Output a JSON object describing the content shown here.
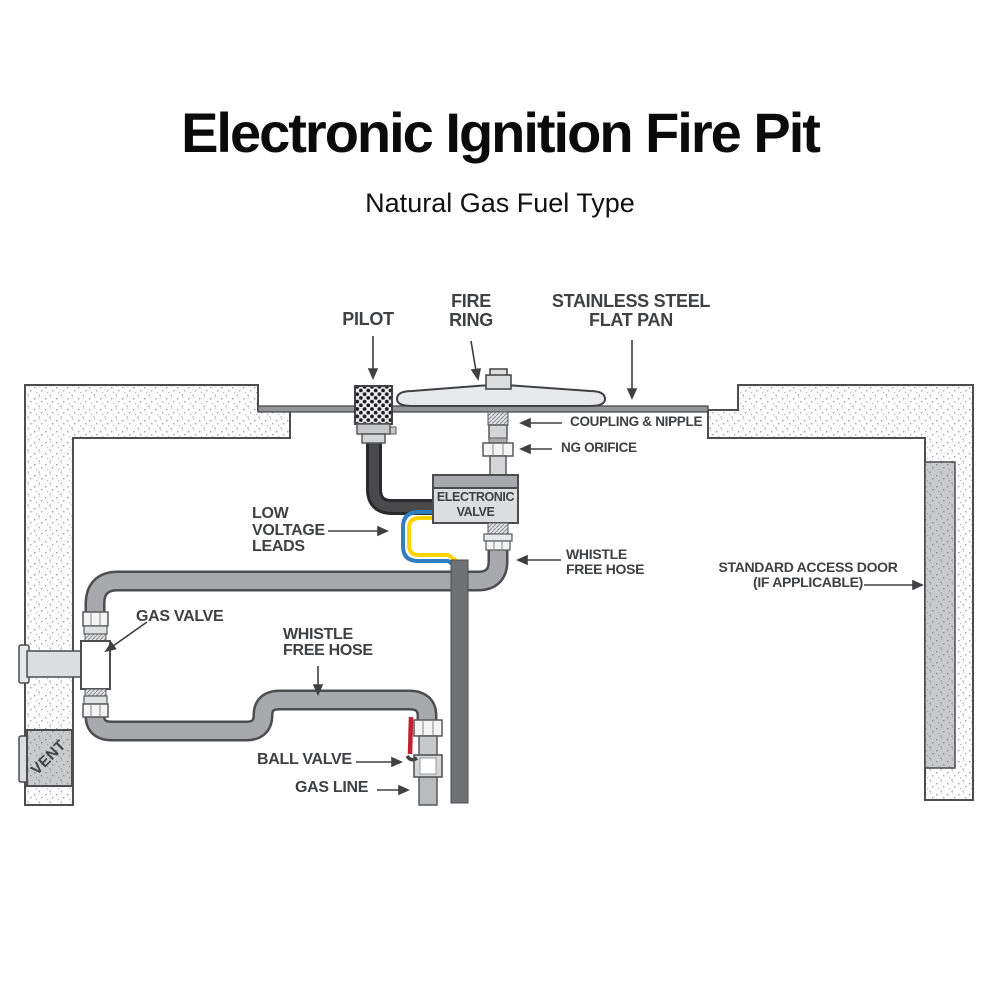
{
  "header": {
    "title": "Electronic Ignition Fire Pit",
    "subtitle": "Natural Gas Fuel Type"
  },
  "labels": {
    "pilot": "PILOT",
    "fire_ring": [
      "FIRE",
      "RING"
    ],
    "flat_pan": [
      "STAINLESS STEEL",
      "FLAT PAN"
    ],
    "coupling_nipple": "COUPLING & NIPPLE",
    "ng_orifice": "NG ORIFICE",
    "electronic_valve": [
      "ELECTRONIC",
      "VALVE"
    ],
    "low_voltage_leads": [
      "LOW",
      "VOLTAGE",
      "LEADS"
    ],
    "whistle_free_hose_upper": [
      "WHISTLE",
      "FREE HOSE"
    ],
    "whistle_free_hose_lower": [
      "WHISTLE",
      "FREE HOSE"
    ],
    "standard_access_door": [
      "STANDARD ACCESS DOOR",
      "(IF APPLICABLE)"
    ],
    "gas_valve": "GAS VALVE",
    "ball_valve": "BALL VALVE",
    "gas_line": "GAS LINE",
    "vent": "VENT"
  },
  "colors": {
    "label_text": "#3f4042",
    "hose_gray": "#a7a9ac",
    "hose_outline": "#4d4d4f",
    "conduit_gray": "#707174",
    "pilot_hose_black": "#2a2a2c",
    "wire_blue": "#2f7fc0",
    "wire_yellow": "#ffd200",
    "valve_handle_red": "#c3212f",
    "valve_box_fill": "#dcddde",
    "valve_box_header": "#a7a9ac",
    "pan_gray": "#939598"
  }
}
